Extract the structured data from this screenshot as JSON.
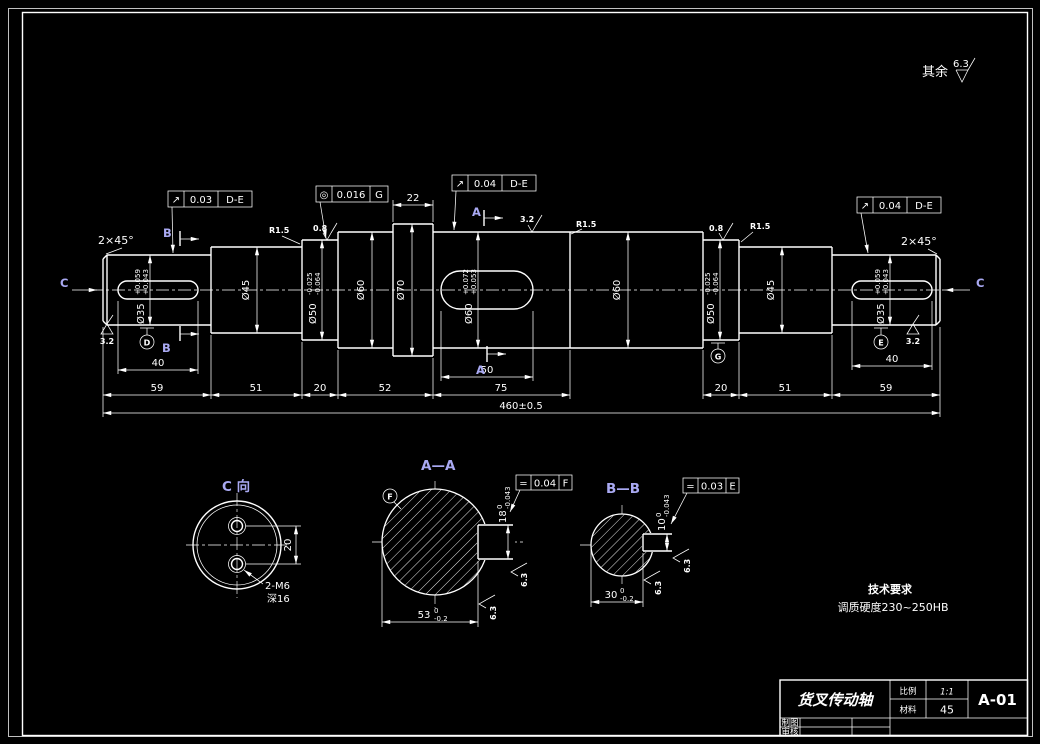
{
  "frame": {
    "surface_note": {
      "prefix": "其余",
      "value": "6.3"
    }
  },
  "shaft": {
    "chamfer_left": "2×45°",
    "chamfer_right": "2×45°",
    "view_arrows": {
      "left": "C",
      "right": "C"
    },
    "section_a": "A",
    "section_b": "B",
    "fcf1": {
      "symbol": "↗",
      "value": "0.03",
      "datum": "D-E"
    },
    "fcf2": {
      "symbol": "◎",
      "value": "0.016",
      "datum": "G"
    },
    "fcf3": {
      "symbol": "↗",
      "value": "0.04",
      "datum": "D-E"
    },
    "fcf4": {
      "symbol": "↗",
      "value": "0.04",
      "datum": "D-E"
    },
    "datums": {
      "d": "D",
      "e": "E",
      "g": "G"
    },
    "roughness": {
      "r32_left": "3.2",
      "r32_mid": "3.2",
      "r32_right": "3.2",
      "r08_left": "0.8",
      "r08_right": "0.8"
    },
    "fillets": {
      "left": "R1.5",
      "mid": "R1.5",
      "right": "R1.5"
    },
    "diameters": {
      "d35_left": {
        "label": "Ø35",
        "up": "+0.059",
        "lo": "+0.043"
      },
      "d45_left": "Ø45",
      "d50_left": {
        "label": "Ø50",
        "up": "-0.025",
        "lo": "-0.064"
      },
      "d60_left": "Ø60",
      "d70": "Ø70",
      "d60_center": {
        "label": "Ø60",
        "up": "+0.072",
        "lo": "+0.053"
      },
      "d60_right": "Ø60",
      "d50_right": {
        "label": "Ø50",
        "up": "-0.025",
        "lo": "-0.064"
      },
      "d45_right": "Ø45",
      "d35_right": {
        "label": "Ø35",
        "up": "+0.059",
        "lo": "+0.043"
      }
    },
    "lengths": {
      "collar": "22",
      "key_left": "40",
      "key_center": "50",
      "key_right": "40",
      "c1": "59",
      "c2": "51",
      "c3": "20",
      "c4": "52",
      "c5": "75",
      "c6": "20",
      "c7": "51",
      "c8": "59",
      "total": "460±0.5"
    }
  },
  "section_aa": {
    "title": "A—A",
    "datum": "F",
    "fcf": {
      "symbol": "=",
      "value": "0.04",
      "datum": "F"
    },
    "key_width": {
      "label": "18",
      "up": "0",
      "lo": "-0.043"
    },
    "key_depth": {
      "label": "53",
      "up": "0",
      "lo": "-0.2"
    },
    "roughness1": "6.3",
    "roughness2": "6.3"
  },
  "section_bb": {
    "title": "B—B",
    "fcf": {
      "symbol": "=",
      "value": "0.03",
      "datum": "E"
    },
    "key_width": {
      "label": "10",
      "up": "0",
      "lo": "-0.043"
    },
    "key_depth": {
      "label": "30",
      "up": "0",
      "lo": "-0.2"
    },
    "roughness1": "6.3",
    "roughness2": "6.3"
  },
  "view_c": {
    "title": "C 向",
    "hole_spacing": "20",
    "hole_note_line1": "2-M6",
    "hole_note_line2": "深16"
  },
  "tech_req": {
    "title": "技术要求",
    "line1": "调质硬度230~250HB"
  },
  "title_block": {
    "part_name": "货叉传动轴",
    "scale_label": "比例",
    "scale_value": "1:1",
    "material_label": "材料",
    "material_value": "45",
    "drawing_no": "A-01",
    "row1_label": "制图",
    "row2_label": "审核"
  }
}
